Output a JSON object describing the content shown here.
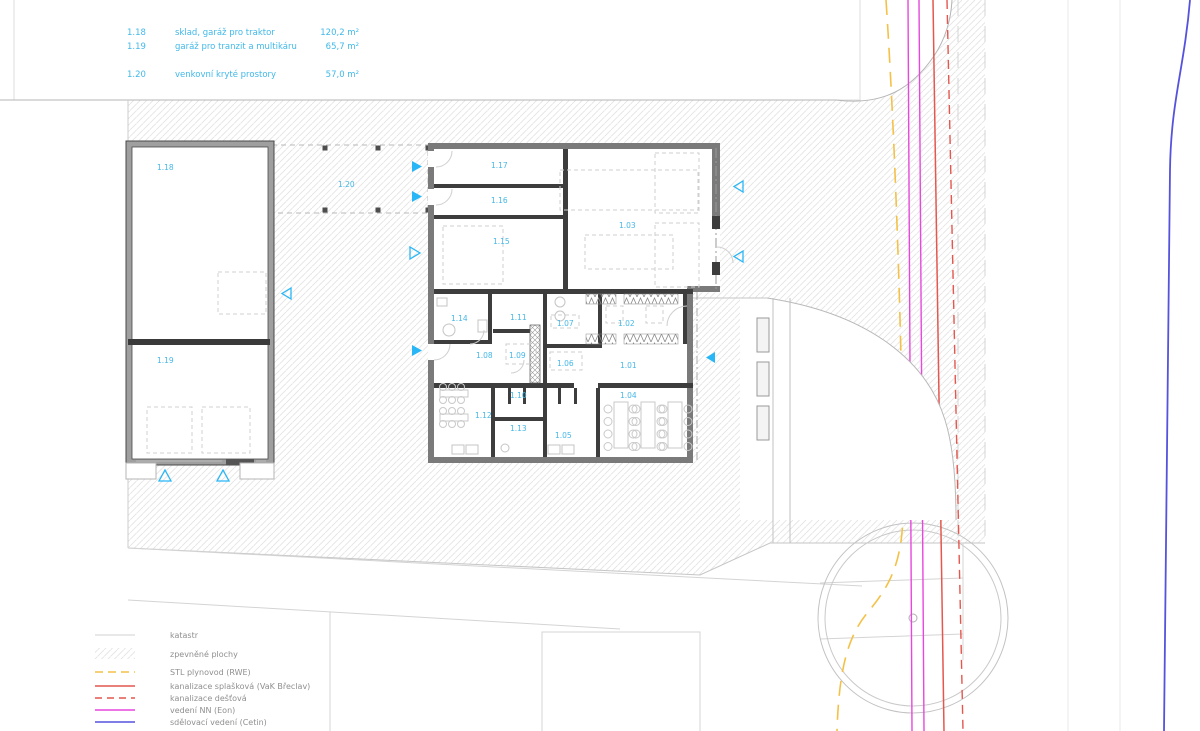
{
  "area_table": {
    "rows": [
      {
        "id": "1.18",
        "name": "sklad, garáž pro traktor",
        "area": "120,2 m²"
      },
      {
        "id": "1.19",
        "name": "garáž pro tranzit a multikáru",
        "area": "65,7 m²"
      },
      {
        "id": "1.20",
        "name": "venkovní kryté prostory",
        "area": "57,0 m²"
      }
    ]
  },
  "room_labels": {
    "r1_01": "1.01",
    "r1_02": "1.02",
    "r1_03": "1.03",
    "r1_04": "1.04",
    "r1_05": "1.05",
    "r1_06": "1.06",
    "r1_07": "1.07",
    "r1_08": "1.08",
    "r1_09": "1.09",
    "r1_10": "1.10",
    "r1_11": "1.11",
    "r1_12": "1.12",
    "r1_13": "1.13",
    "r1_14": "1.14",
    "r1_15": "1.15",
    "r1_16": "1.16",
    "r1_17": "1.17",
    "r1_18": "1.18",
    "r1_19": "1.19",
    "r1_20": "1.20"
  },
  "site_legend": {
    "items": [
      {
        "label": "katastr",
        "type": "line-gray"
      },
      {
        "label": "zpevněné plochy",
        "type": "hatch"
      },
      {
        "label": "STL plynovod (RWE)",
        "type": "dashed-yellow"
      },
      {
        "label": "kanalizace splašková (VaK Břeclav)",
        "type": "line-red"
      },
      {
        "label": "kanalizace dešťová",
        "type": "dashed-red"
      },
      {
        "label": "vedení NN (Eon)",
        "type": "line-magenta"
      },
      {
        "label": "sdělovací vedení (Cetin)",
        "type": "line-blue"
      }
    ]
  },
  "colors": {
    "room_label_cyan": "#45b8e8",
    "entrance_arrow_cyan": "#29b6f6",
    "gas_yellow": "#f4c146",
    "sewer_red": "#e4574e",
    "power_magenta": "#e747dd",
    "comm_blue": "#5553dd",
    "wall_dark": "#3d3d3d",
    "wall_gray": "#7a7a7a",
    "hatch_gray": "#e3e3e3",
    "legend_text_gray": "#8f8f8f"
  }
}
